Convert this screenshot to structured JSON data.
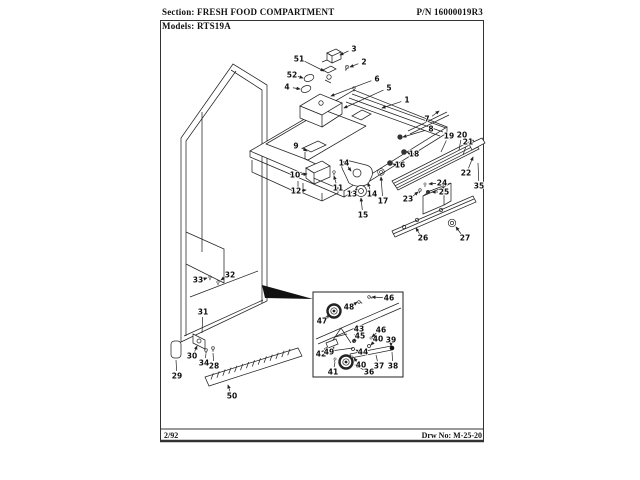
{
  "header": {
    "section_label": "Section:",
    "section_value": "FRESH FOOD COMPARTMENT",
    "part_number": "P/N 16000019R3",
    "models_label": "Models:",
    "models_value": "RTS19A"
  },
  "footer": {
    "revision_date": "2/92",
    "drawing_number": "Drw No: M-25-20"
  },
  "diagram": {
    "description": "Exploded parts view of refrigerator fresh food compartment with numbered callouts and roller detail inset",
    "callouts": [
      {
        "label": "1",
        "x": 407,
        "y": 100,
        "tx": 382,
        "ty": 108
      },
      {
        "label": "2",
        "x": 364,
        "y": 62,
        "tx": 350,
        "ty": 67
      },
      {
        "label": "3",
        "x": 354,
        "y": 49,
        "tx": 340,
        "ty": 55
      },
      {
        "label": "4",
        "x": 287,
        "y": 87,
        "tx": 300,
        "ty": 89
      },
      {
        "label": "5",
        "x": 389,
        "y": 88,
        "tx": 344,
        "ty": 108
      },
      {
        "label": "6",
        "x": 377,
        "y": 79,
        "tx": 331,
        "ty": 96
      },
      {
        "label": "7",
        "x": 427,
        "y": 119,
        "tx": 439,
        "ty": 111
      },
      {
        "label": "8",
        "x": 431,
        "y": 129,
        "tx": 403,
        "ty": 137
      },
      {
        "label": "9",
        "x": 296,
        "y": 146,
        "tx": 307,
        "ty": 151
      },
      {
        "label": "10",
        "x": 295,
        "y": 175,
        "tx": 307,
        "ty": 174
      },
      {
        "label": "11",
        "x": 338,
        "y": 188,
        "tx": 334,
        "ty": 176
      },
      {
        "label": "12",
        "x": 296,
        "y": 191,
        "tx": 306,
        "ty": 190
      },
      {
        "label": "13",
        "x": 352,
        "y": 194,
        "tx": 357,
        "ty": 189
      },
      {
        "label": "14",
        "x": 344,
        "y": 163,
        "tx": 351,
        "ty": 171
      },
      {
        "label": "14",
        "x": 372,
        "y": 194,
        "tx": 368,
        "ty": 183
      },
      {
        "label": "15",
        "x": 363,
        "y": 215,
        "tx": 361,
        "ty": 198
      },
      {
        "label": "16",
        "x": 400,
        "y": 165,
        "tx": 393,
        "ty": 164
      },
      {
        "label": "17",
        "x": 383,
        "y": 201,
        "tx": 381,
        "ty": 177
      },
      {
        "label": "18",
        "x": 414,
        "y": 154,
        "tx": 407,
        "ty": 152
      },
      {
        "label": "19",
        "x": 449,
        "y": 136,
        "tx": 441,
        "ty": 152,
        "arrow": false
      },
      {
        "label": "20",
        "x": 462,
        "y": 135,
        "tx": 459,
        "ty": 150,
        "arrow": false
      },
      {
        "label": "21",
        "x": 468,
        "y": 142,
        "tx": 463,
        "ty": 155,
        "arrow": false
      },
      {
        "label": "22",
        "x": 466,
        "y": 173,
        "tx": 473,
        "ty": 157
      },
      {
        "label": "23",
        "x": 408,
        "y": 199,
        "tx": 418,
        "ty": 192
      },
      {
        "label": "24",
        "x": 442,
        "y": 183,
        "tx": 429,
        "ty": 184
      },
      {
        "label": "25",
        "x": 444,
        "y": 192,
        "tx": 432,
        "ty": 192
      },
      {
        "label": "26",
        "x": 423,
        "y": 238,
        "tx": 416,
        "ty": 228
      },
      {
        "label": "27",
        "x": 465,
        "y": 238,
        "tx": 456,
        "ty": 227
      },
      {
        "label": "28",
        "x": 214,
        "y": 366,
        "tx": 213,
        "ty": 353,
        "arrow": false
      },
      {
        "label": "29",
        "x": 177,
        "y": 376,
        "tx": 176,
        "ty": 360,
        "arrow": false
      },
      {
        "label": "30",
        "x": 192,
        "y": 356,
        "tx": 197,
        "ty": 346
      },
      {
        "label": "31",
        "x": 203,
        "y": 312,
        "tx": 202,
        "ty": 333,
        "arrow": false
      },
      {
        "label": "32",
        "x": 230,
        "y": 275,
        "tx": 221,
        "ty": 280
      },
      {
        "label": "33",
        "x": 198,
        "y": 280,
        "tx": 207,
        "ty": 278
      },
      {
        "label": "34",
        "x": 204,
        "y": 363,
        "tx": 206,
        "ty": 354,
        "arrow": false
      },
      {
        "label": "35",
        "x": 479,
        "y": 186,
        "tx": 478,
        "ty": 163,
        "arrow": false
      },
      {
        "label": "36",
        "x": 369,
        "y": 372,
        "tx": 355,
        "ty": 365
      },
      {
        "label": "37",
        "x": 379,
        "y": 366,
        "tx": 376,
        "ty": 355,
        "arrow": false
      },
      {
        "label": "38",
        "x": 393,
        "y": 366,
        "tx": 392,
        "ty": 352,
        "arrow": false
      },
      {
        "label": "39",
        "x": 391,
        "y": 340,
        "tx": 391,
        "ty": 346
      },
      {
        "label": "40",
        "x": 378,
        "y": 339,
        "tx": 371,
        "ty": 345
      },
      {
        "label": "40",
        "x": 361,
        "y": 365,
        "tx": 354,
        "ty": 358
      },
      {
        "label": "41",
        "x": 333,
        "y": 372,
        "tx": 335,
        "ty": 362,
        "arrow": false
      },
      {
        "label": "42",
        "x": 321,
        "y": 354,
        "tx": 327,
        "ty": 347
      },
      {
        "label": "43",
        "x": 359,
        "y": 329,
        "tx": 355,
        "ty": 338
      },
      {
        "label": "44",
        "x": 363,
        "y": 352,
        "tx": 356,
        "ty": 350
      },
      {
        "label": "45",
        "x": 360,
        "y": 336,
        "tx": 353,
        "ty": 342
      },
      {
        "label": "46",
        "x": 389,
        "y": 298,
        "tx": 372,
        "ty": 297
      },
      {
        "label": "46",
        "x": 381,
        "y": 330,
        "tx": 372,
        "ty": 337
      },
      {
        "label": "47",
        "x": 322,
        "y": 321,
        "tx": 329,
        "ty": 315
      },
      {
        "label": "48",
        "x": 349,
        "y": 307,
        "tx": 357,
        "ty": 302
      },
      {
        "label": "49",
        "x": 329,
        "y": 352,
        "tx": 334,
        "ty": 347
      },
      {
        "label": "50",
        "x": 232,
        "y": 396,
        "tx": 228,
        "ty": 385
      },
      {
        "label": "51",
        "x": 299,
        "y": 59,
        "tx": 324,
        "ty": 71
      },
      {
        "label": "52",
        "x": 292,
        "y": 75,
        "tx": 303,
        "ty": 78
      }
    ]
  }
}
